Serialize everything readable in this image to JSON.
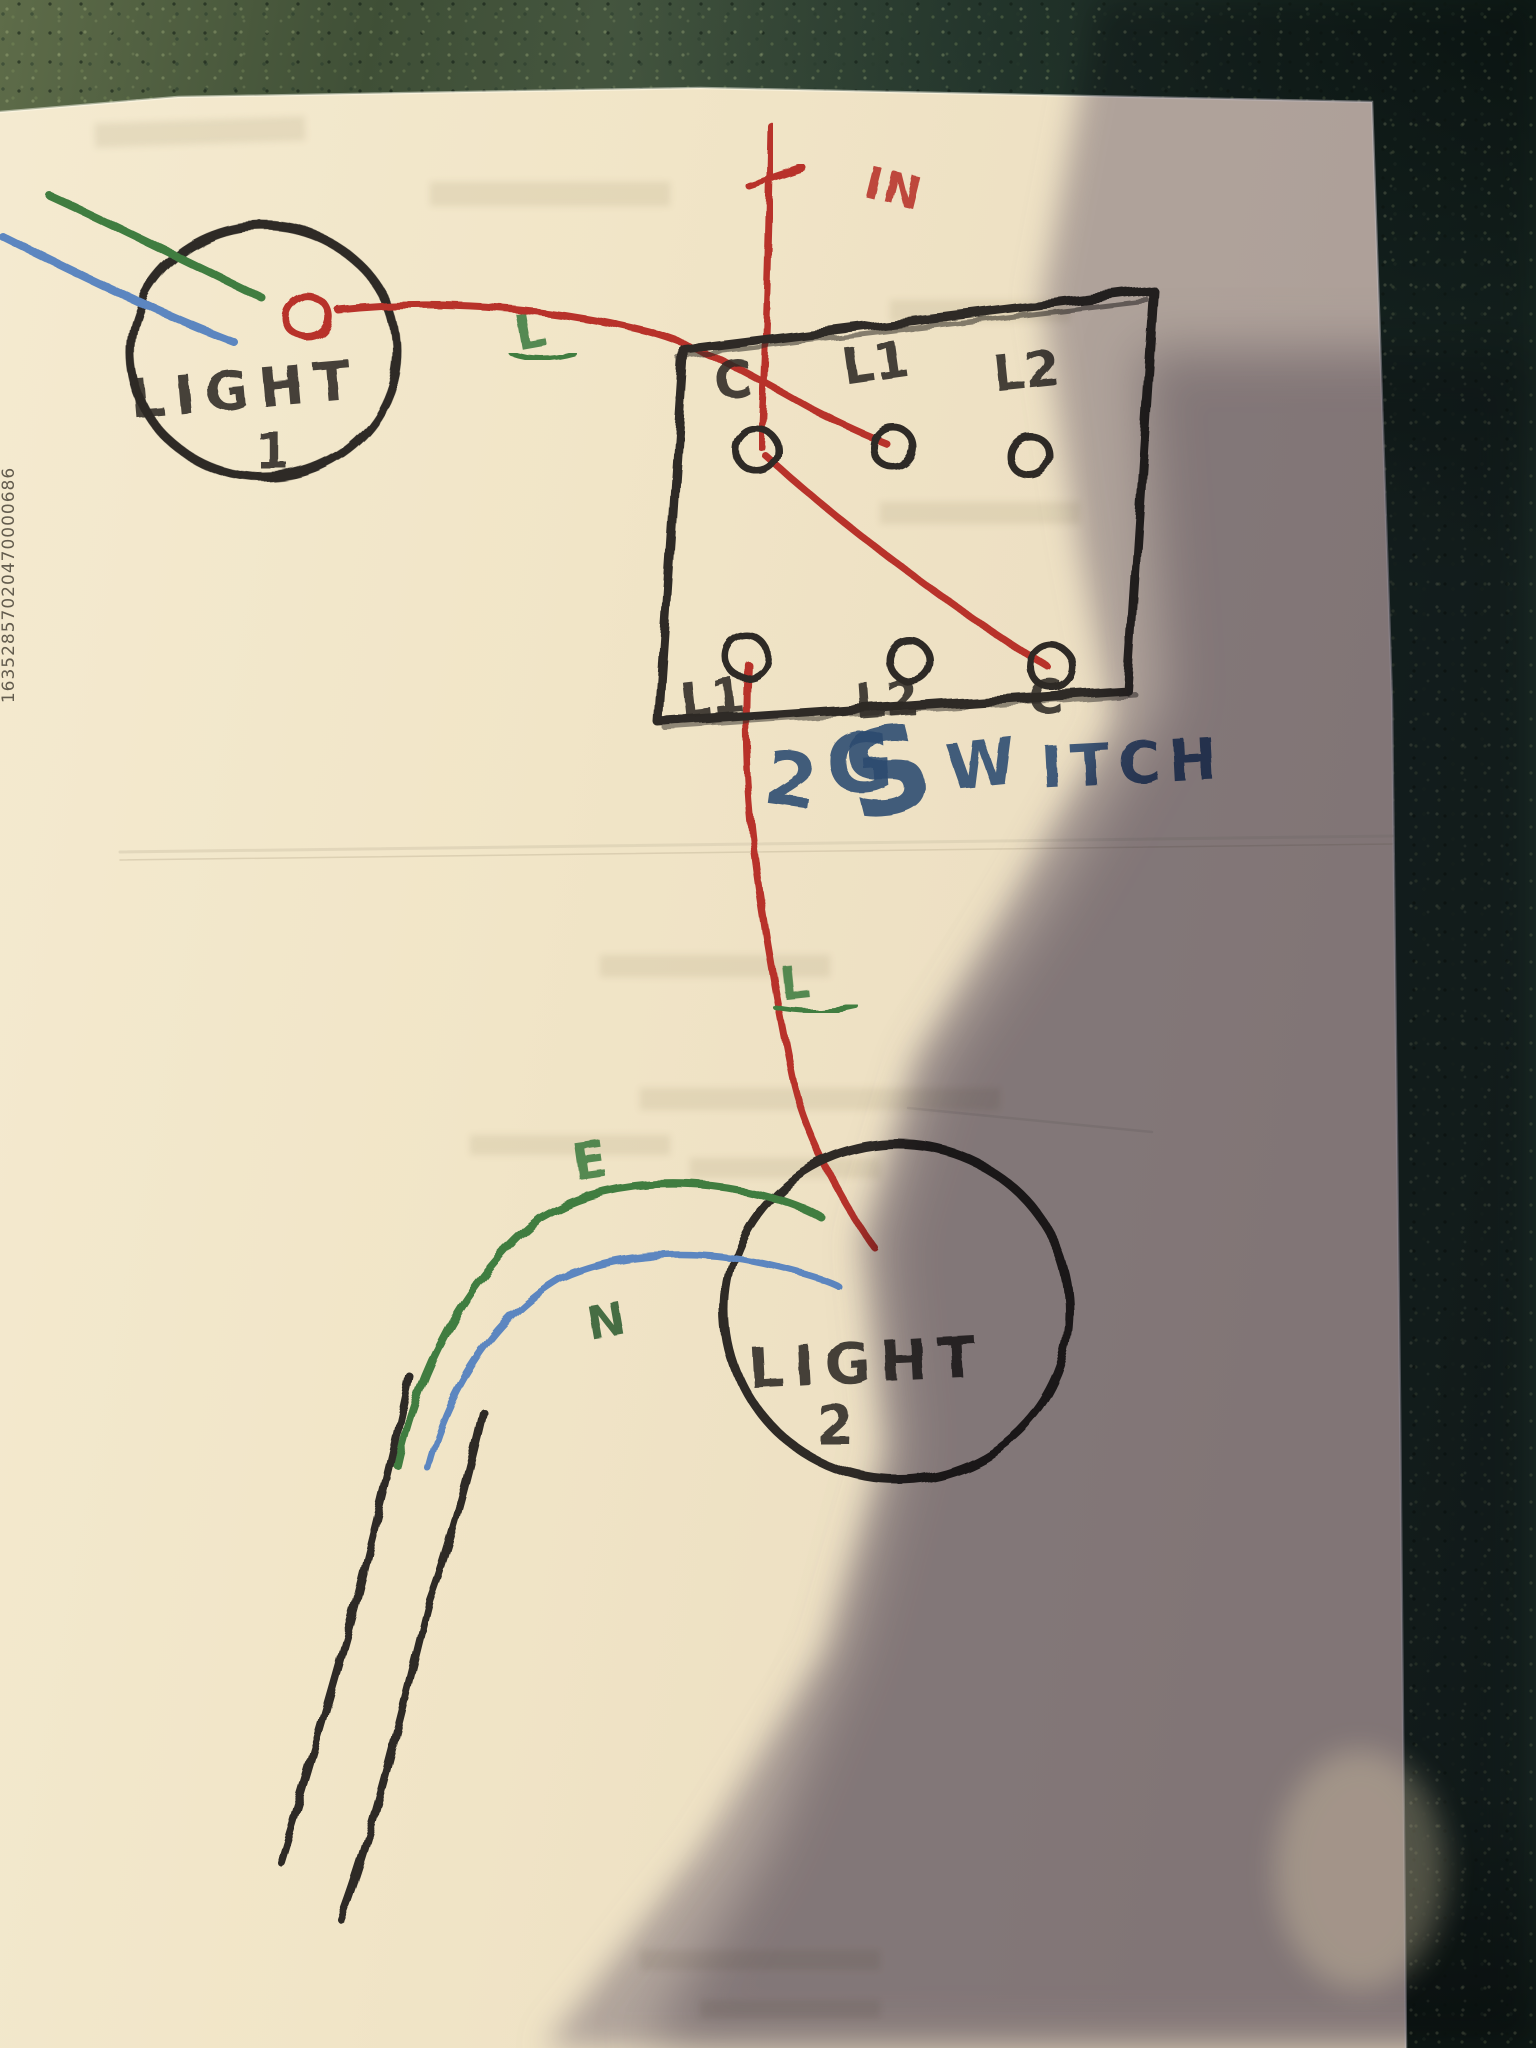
{
  "photo": {
    "paper_edge_code": "16352857020470000686"
  },
  "diagram": {
    "feed_label": "IN",
    "live_label_upper": "L",
    "live_label_lower": "L",
    "earth_label": "E",
    "neutral_label": "N",
    "light1": {
      "name": "LIGHT",
      "number": "1"
    },
    "light2": {
      "name": "LIGHT",
      "number": "2"
    },
    "switch": {
      "top_terminals": [
        "C",
        "L1",
        "L2"
      ],
      "bottom_terminals": [
        "L1",
        "L2",
        "C"
      ],
      "name_parts": {
        "two": "2",
        "g": "G",
        "s": "S",
        "w": "W",
        "itch": "ITCH"
      }
    },
    "colors": {
      "live": "#b8322c",
      "earth": "#3f7d41",
      "neutral": "#5b86c0",
      "outline": "#2f2b27",
      "ink": "#2b4a70"
    }
  }
}
